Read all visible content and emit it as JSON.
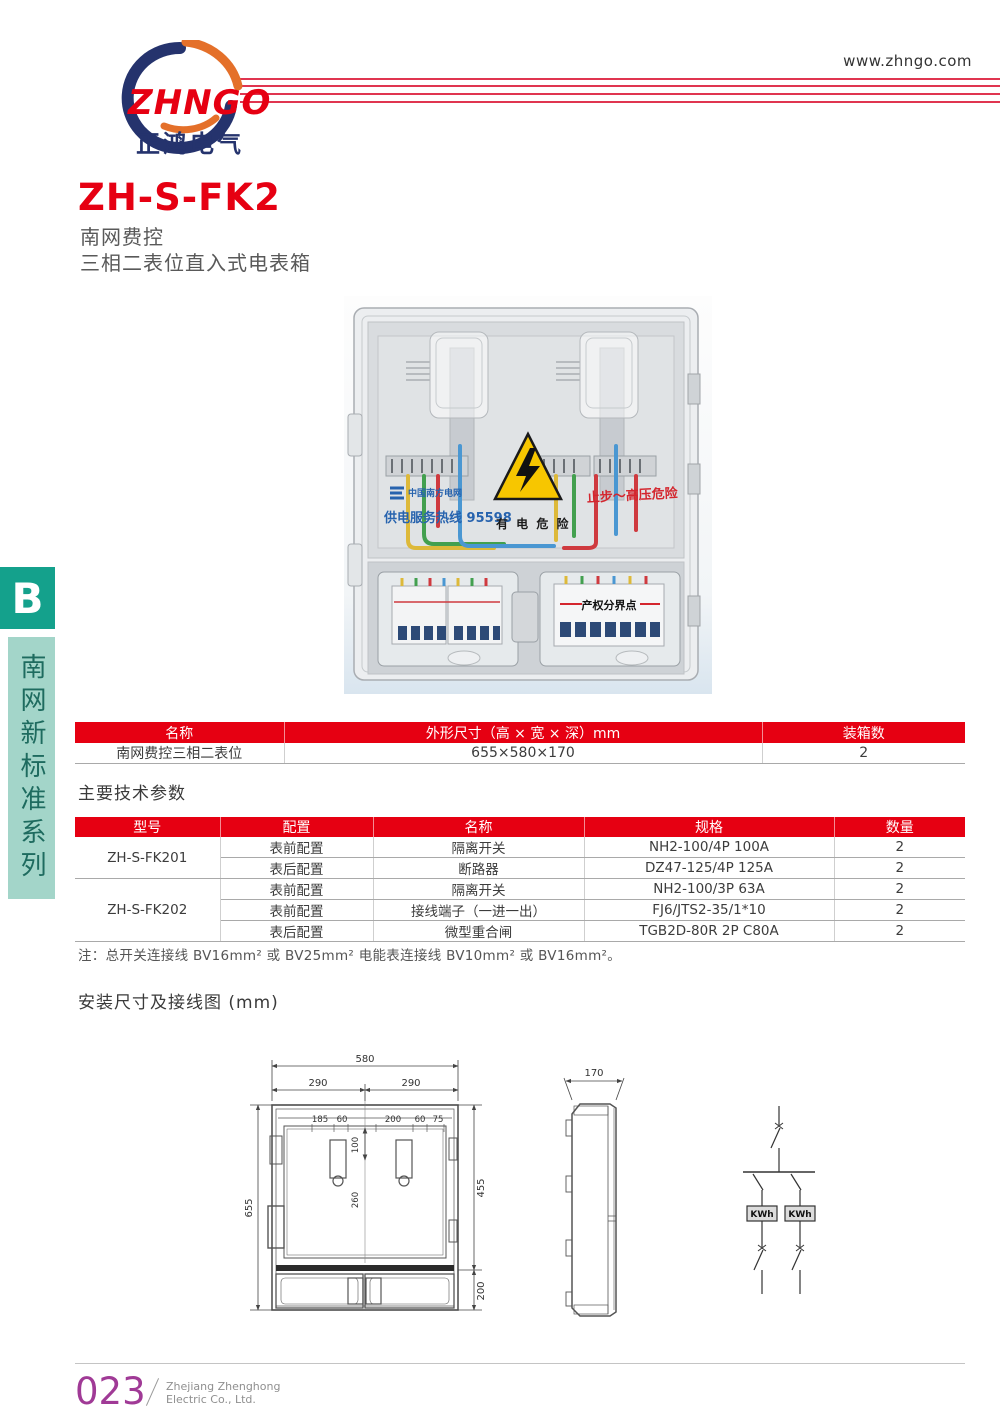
{
  "header": {
    "logo_text": "ZHNGO",
    "logo_subtext": "正鸿电气",
    "website": "www.zhngo.com"
  },
  "title": {
    "model": "ZH-S-FK2",
    "line1": "南网费控",
    "line2": "三相二表位直入式电表箱"
  },
  "sidebar": {
    "section_letter": "B",
    "series_label": "南网新标准系列"
  },
  "photo": {
    "grid_logo_text": "中国南方电网",
    "hotline_text": "供电服务热线 95598",
    "warning_text": "有 电 危 险",
    "danger_text": "止步～高压危险",
    "breaker_label": "产权分界点"
  },
  "size_table": {
    "headers": [
      "名称",
      "外形尺寸（高 × 宽 × 深）mm",
      "装箱数"
    ],
    "row": {
      "name": "南网费控三相二表位",
      "dimensions": "655×580×170",
      "qty": "2"
    }
  },
  "params_table": {
    "heading": "主要技术参数",
    "headers": [
      "型号",
      "配置",
      "名称",
      "规格",
      "数量"
    ],
    "models": [
      {
        "name": "ZH-S-FK201"
      },
      {
        "name": "ZH-S-FK202"
      }
    ],
    "rows": [
      {
        "config": "表前配置",
        "item": "隔离开关",
        "spec": "NH2-100/4P 100A",
        "qty": "2"
      },
      {
        "config": "表后配置",
        "item": "断路器",
        "spec": "DZ47-125/4P 125A",
        "qty": "2"
      },
      {
        "config": "表前配置",
        "item": "隔离开关",
        "spec": "NH2-100/3P 63A",
        "qty": "2"
      },
      {
        "config": "表前配置",
        "item": "接线端子（一进一出）",
        "spec": "FJ6/JTS2-35/1*10",
        "qty": "2"
      },
      {
        "config": "表后配置",
        "item": "微型重合闸",
        "spec": "TGB2D-80R 2P C80A",
        "qty": "2"
      }
    ]
  },
  "note": {
    "text": "注：总开关连接线 BV16mm² 或 BV25mm² 电能表连接线 BV10mm² 或 BV16mm²。"
  },
  "install": {
    "heading": "安装尺寸及接线图 (mm)"
  },
  "drawing": {
    "front": {
      "total_width": "580",
      "left_half": "290",
      "right_half": "290",
      "pitch_a": "185",
      "pitch_b": "60",
      "pitch_c": "200",
      "pitch_d": "60",
      "pitch_e": "75",
      "hanger_height": "100",
      "center_height": "260",
      "total_height": "655",
      "upper_height": "455",
      "lower_height": "200"
    },
    "side": {
      "depth": "170"
    },
    "circuit": {
      "meter_left": "KWh",
      "meter_right": "KWh"
    }
  },
  "footer": {
    "page_number": "023",
    "company_line1": "Zhejiang Zhenghong",
    "company_line2": "Electric Co., Ltd."
  },
  "colors": {
    "accent_red": "#e60012",
    "brand_navy": "#25336d",
    "brand_orange": "#e4702a",
    "sidebar_teal": "#14a18c",
    "sidebar_light": "#a3d5c9",
    "page_num_purple": "#a03a96"
  }
}
